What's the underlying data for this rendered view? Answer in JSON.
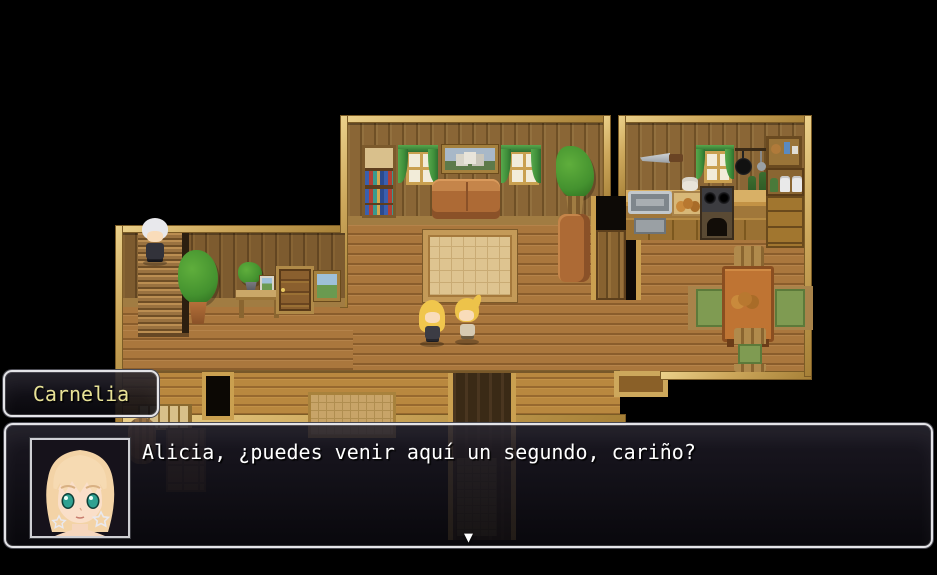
{
  "screen": {
    "width": 937,
    "height": 575,
    "scene": "house-interior"
  },
  "name_box": {
    "text": "Carnelia",
    "text_color": "#e8e296"
  },
  "message_box": {
    "text": "Alicia, ¿puedes venir aquí un segundo, cariño?",
    "text_color": "#ffffff",
    "continue_indicator": "▼"
  },
  "portrait": {
    "character": "Carnelia",
    "style": "anime-bust",
    "hair_color": "#f3d3a6",
    "eye_color": "#2fa191",
    "skin_color": "#fadfc9",
    "earrings": "star"
  },
  "map": {
    "characters": [
      "white-haired-person-on-stairs",
      "blonde-girl-long-hair",
      "blonde-girl-ponytail"
    ],
    "rooms": [
      "living-room",
      "kitchen",
      "left-hallway",
      "dining-area",
      "south-hall"
    ],
    "furniture": [
      "stairs",
      "potted-plant",
      "side-table",
      "photo-frame",
      "wooden-door",
      "landscape-painting",
      "bookshelf",
      "curtained-window",
      "castle-painting",
      "curtained-window",
      "leather-sofa",
      "tall-plant",
      "patterned-rug",
      "leather-armchair",
      "passage-door",
      "wall-knife",
      "kitchen-window",
      "hanging-pans",
      "wine-bottles",
      "wall-shelf",
      "sink",
      "cutting-board",
      "stove",
      "counter-cabinets",
      "jar-shelf",
      "dresser",
      "dining-table",
      "bread-basket",
      "dining-chairs",
      "south-door",
      "entry-mat",
      "corridor",
      "barrel",
      "panel-door"
    ],
    "colors": {
      "floor": "#aa773d",
      "wall": "#8a6636",
      "trim": "#cda85c",
      "curtain": "#4d9a44",
      "rug": "#dec490"
    }
  }
}
